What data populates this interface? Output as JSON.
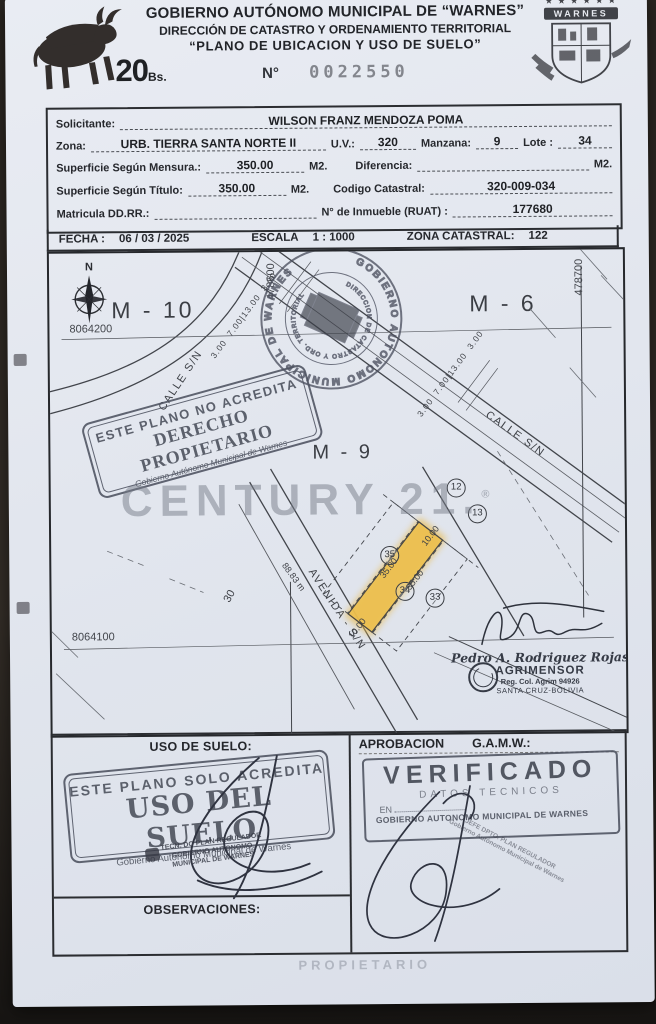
{
  "header": {
    "line1": "GOBIERNO AUTÓNOMO MUNICIPAL DE “WARNES”",
    "line2": "DIRECCIÓN DE CATASTRO Y ORDENAMIENTO TERRITORIAL",
    "line3": "“PLANO DE UBICACION Y USO DE SUELO”",
    "number_label": "N°",
    "number_value": "0022550",
    "fee_value": "20",
    "fee_unit": "Bs.",
    "crest": {
      "stars": "★ ★ ★ ★ ★ ★",
      "banner": "WARNES"
    }
  },
  "form": {
    "solicitante_label": "Solicitante:",
    "solicitante_value": "WILSON FRANZ MENDOZA POMA",
    "zona_label": "Zona:",
    "zona_value": "URB. TIERRA SANTA NORTE II",
    "uv_label": "U.V.:",
    "uv_value": "320",
    "manzana_label": "Manzana:",
    "manzana_value": "9",
    "lote_label": "Lote :",
    "lote_value": "34",
    "sup_mensura_label": "Superficie Según Mensura.:",
    "sup_mensura_value": "350.00",
    "m2": "M2.",
    "diferencia_label": "Diferencia:",
    "diferencia_value": "",
    "sup_titulo_label": "Superficie Según Título:",
    "sup_titulo_value": "350.00",
    "codigo_catastral_label": "Codigo Catastral:",
    "codigo_catastral_value": "320-009-034",
    "matricula_label": "Matricula DD.RR.:",
    "matricula_value": "",
    "ruat_label": "N° de Inmueble (RUAT) :",
    "ruat_value": "177680",
    "fecha_label": "FECHA :",
    "fecha_value": "06 / 03 / 2025",
    "escala_label": "ESCALA",
    "escala_value": "1 : 1000",
    "zona_catastral_label": "ZONA CATASTRAL:",
    "zona_catastral_value": "122"
  },
  "map": {
    "north": "N",
    "block_m10": "M - 10",
    "block_m6": "M - 6",
    "block_m9": "M - 9",
    "grid_north_1": "8064200",
    "grid_north_2": "8064100",
    "grid_east_1": "478600",
    "grid_east_2": "478700",
    "street_calle_1": "CALLE S/N",
    "street_calle_2": "CALLE S/N",
    "street_avenida": "AVENIDA - S/N",
    "road_dims": [
      "3.00",
      "7.00",
      "13.00",
      "3.00"
    ],
    "lot_12": "12",
    "lot_13": "13",
    "lot_33": "33",
    "lot_34": "34",
    "lot_35": "35",
    "dim_front_top": "10.00",
    "dim_side_left": "35.00",
    "dim_side_right": "35.00",
    "dim_front_bottom": "10.00",
    "dim_block_length": "88.83 m",
    "dim_block_width": "30",
    "highlight_color": "#eec04d",
    "stamp_no_acredita": {
      "line1": "ESTE PLANO NO ACREDITA",
      "line2": "DERECHO PROPIETARIO",
      "line3": "Gobierno Autónomo Municipal de Warnes"
    },
    "stamp_municipal": {
      "ring_text": "GOBIERNO AUTONOMO MUNICIPAL DE WARNES",
      "inner_text": "DIRECCION DE CATASTRO Y ORD. TERRITORIAL"
    },
    "surveyor": {
      "name": "Pedro A. Rodriguez Rojas",
      "title": "AGRIMENSOR",
      "registration": "Reg. Col. Agrim 94926",
      "location": "SANTA CRUZ-BOLIVIA"
    },
    "watermark": "CENTURY 21.",
    "watermark_reg": "®"
  },
  "footer": {
    "uso_title": "USO DE SUELO:",
    "stamp_uso": {
      "line1": "ESTE PLANO SOLO ACREDITA",
      "line2": "USO DEL SUELO",
      "line3": "Gobierno Autónomo Municipal de Warnes"
    },
    "stamp_small_left": [
      "TECN. DO PLAN REGULADOR",
      "GOBIERNO AUTONOMO",
      "MUNICIPAL DE WARNES"
    ],
    "aprobacion_label": "APROBACION",
    "aprobacion_org": "G.A.M.W.:",
    "stamp_verificado": {
      "line1": "VERIFICADO",
      "line2": "DATOS TECNICOS",
      "line3": "EN",
      "line4": "GOBIERNO AUTONOMO MUNICIPAL DE WARNES"
    },
    "stamp_small_right": [
      "JEFE DPTO. PLAN REGULADOR",
      "Gobierno Autónomo Municipal de Warnes"
    ],
    "observaciones_title": "OBSERVACIONES:",
    "bleed_text": "PROPIETARIO"
  }
}
